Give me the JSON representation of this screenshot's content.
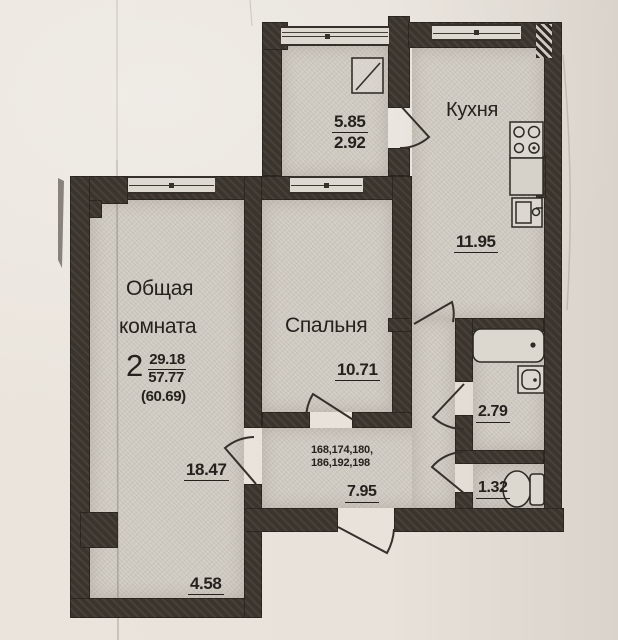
{
  "colors": {
    "paper": "#e8e2da",
    "room_fill": "#d3cec6",
    "wall": "#3a342d",
    "ink": "#25221e"
  },
  "rooms": {
    "balcony": {
      "area_full": "5.85",
      "area_coeff": "2.92"
    },
    "kitchen": {
      "name": "Кухня",
      "area": "11.95"
    },
    "living": {
      "name_line1": "Общая",
      "name_line2": "комната",
      "area": "18.47",
      "area_lower": "4.58"
    },
    "bedroom": {
      "name": "Спальня",
      "area": "10.71"
    },
    "hallway": {
      "apartments_line1": "168,174,180,",
      "apartments_line2": "186,192,198",
      "area": "7.95"
    },
    "bathroom": {
      "area": "2.79"
    },
    "wc": {
      "area": "1.32"
    }
  },
  "summary": {
    "room_count": "2",
    "living_area": "29.18",
    "total_area": "57.77",
    "total_with_coeff": "(60.69)"
  },
  "icons": {
    "stove": "stove-icon",
    "kitchen_sink": "sink-icon",
    "bathtub": "bathtub-icon",
    "washbasin": "washbasin-icon",
    "toilet": "toilet-icon",
    "balcony_window": "window-icon"
  }
}
